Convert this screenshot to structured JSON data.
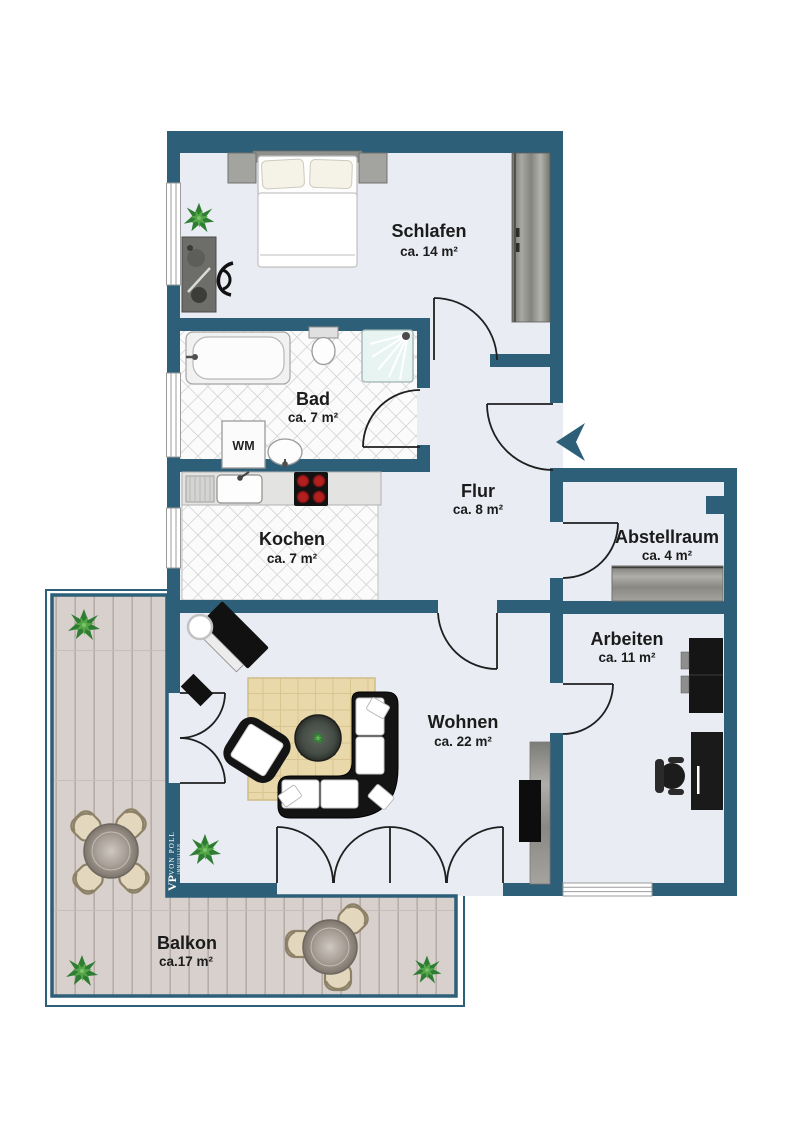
{
  "colors": {
    "wall": "#2e5f78",
    "floor": "#e9ecf3",
    "tile_line": "#c9c9c9",
    "deck": "#d8d0cc",
    "deck_line": "#b7aca8",
    "rug": "#e8d8aa",
    "rug_line": "#d9c58f",
    "label": "#1b1b1b"
  },
  "rooms": {
    "schlafen": {
      "name": "Schlafen",
      "area": "ca. 14 m²"
    },
    "bad": {
      "name": "Bad",
      "area": "ca. 7 m²"
    },
    "kochen": {
      "name": "Kochen",
      "area": "ca. 7 m²"
    },
    "flur": {
      "name": "Flur",
      "area": "ca. 8 m²"
    },
    "abstellraum": {
      "name": "Abstellraum",
      "area": "ca. 4 m²"
    },
    "arbeiten": {
      "name": "Arbeiten",
      "area": "ca. 11 m²"
    },
    "wohnen": {
      "name": "Wohnen",
      "area": "ca. 22 m²"
    },
    "balkon": {
      "name": "Balkon",
      "area": "ca.17 m²"
    }
  },
  "labels": {
    "washing_machine": "WM"
  },
  "branding": {
    "logo_vp": "VP",
    "logo_von_poll": "VON POLL",
    "logo_immobilien": "IMMOBILIEN"
  },
  "icons": {
    "entrance_marker": "arrow-left"
  }
}
